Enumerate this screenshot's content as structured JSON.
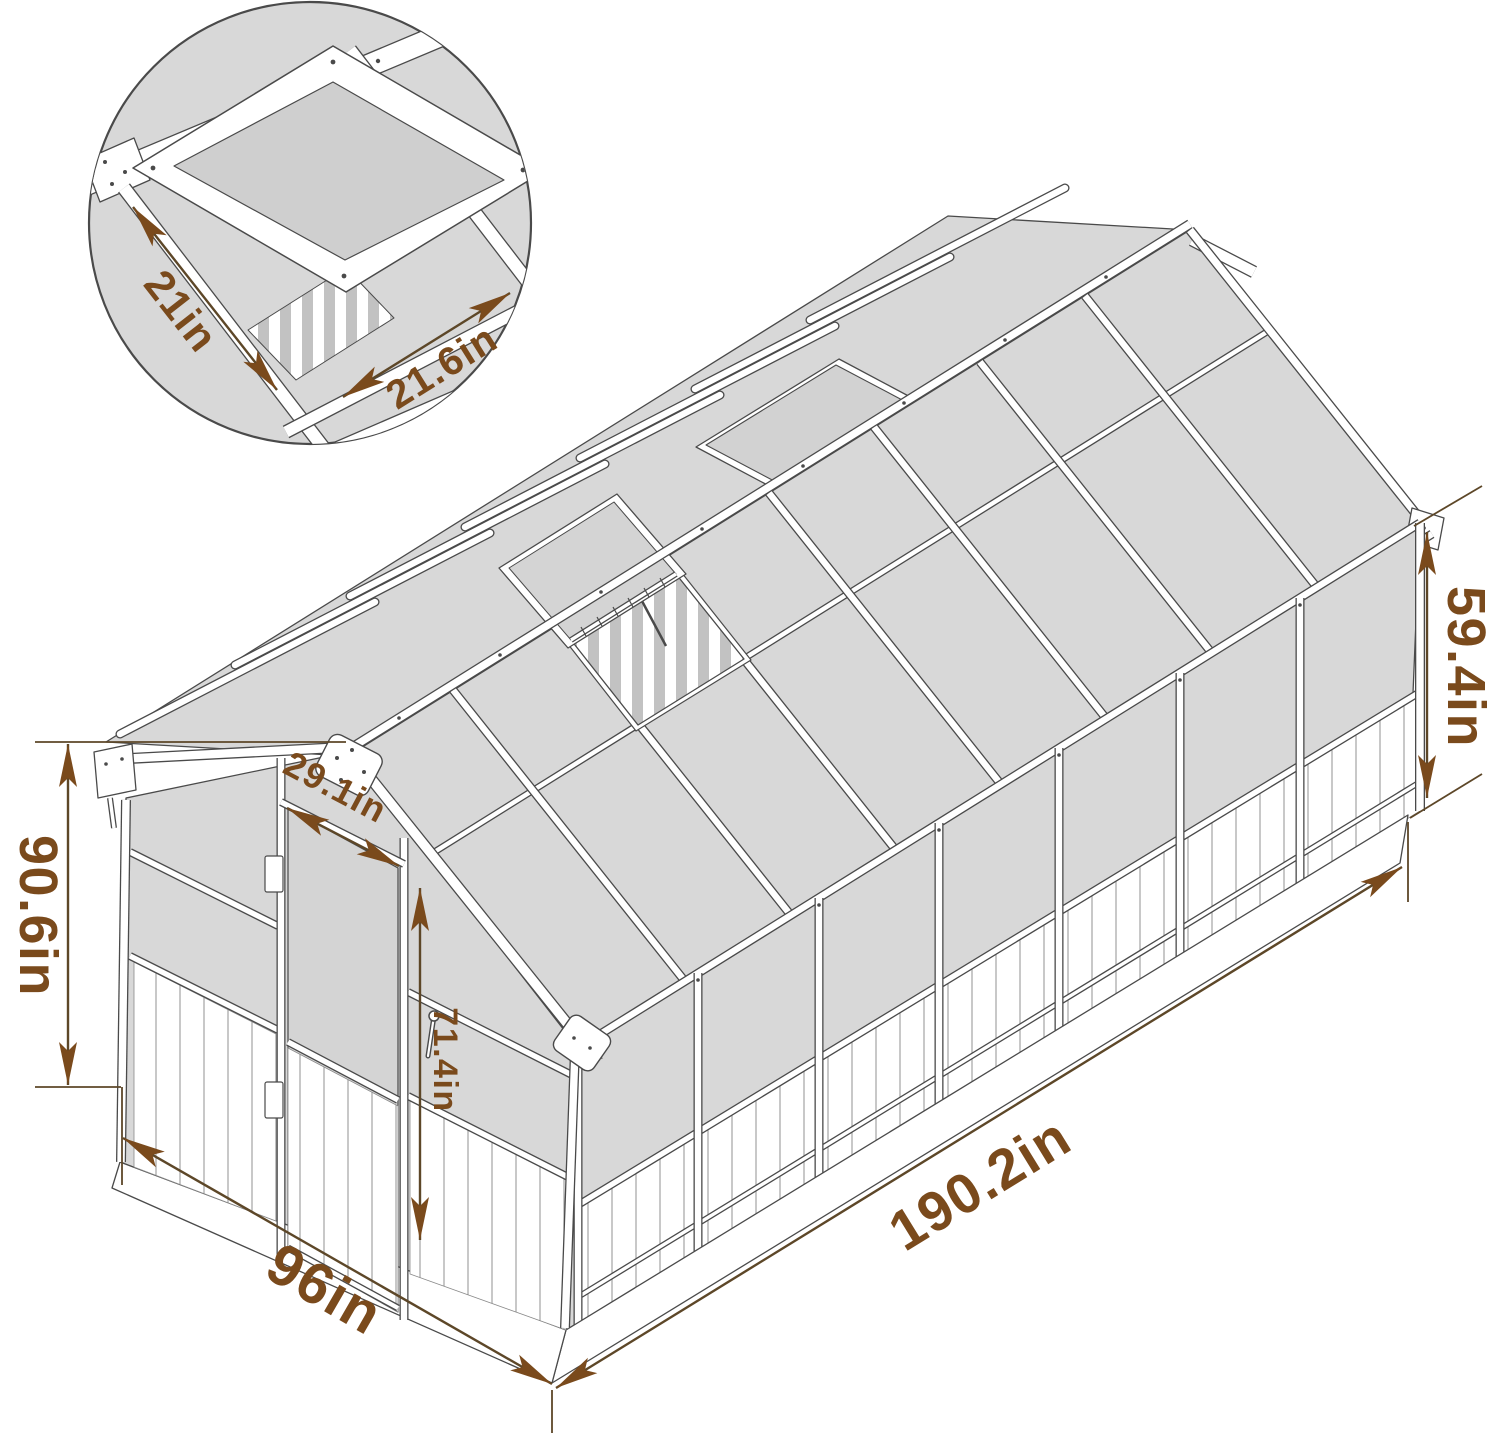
{
  "inset": {
    "vent_width_label": "21in",
    "vent_length_label": "21.6in"
  },
  "dimensions": {
    "total_height": "90.6in",
    "roof_panel_height": "59.4in",
    "door_width": "29.1in",
    "door_height": "71.4in",
    "length": "190.2in",
    "width": "96in"
  },
  "colors": {
    "dimension_accent": "#7a4a1c",
    "dimension_line": "#5d4728",
    "panel_gray": "#d8d8d8",
    "line_gray": "#4a4a4a"
  }
}
